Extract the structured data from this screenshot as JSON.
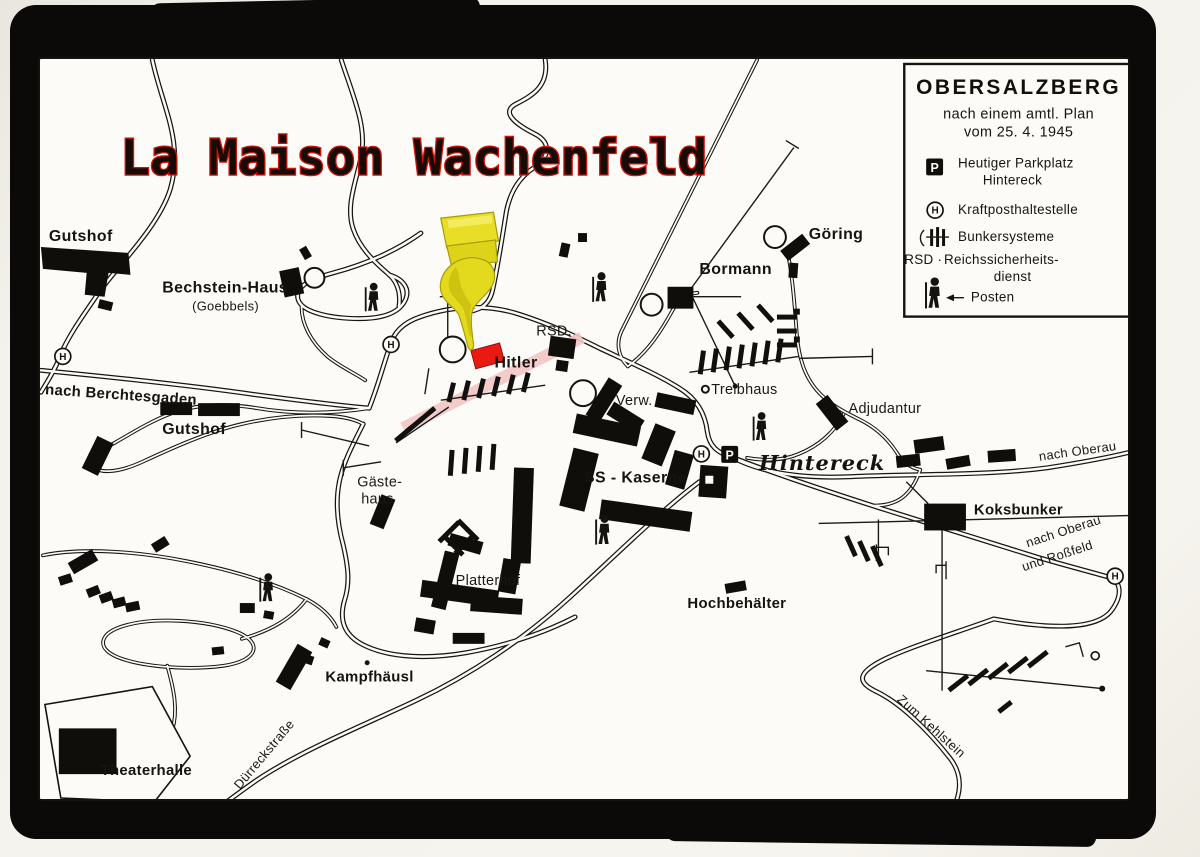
{
  "title": "La Maison Wachenfeld",
  "legend": {
    "heading": "OBERSALZBERG",
    "line1": "nach einem amtl. Plan",
    "line2": "vom 25. 4. 1945",
    "parkplatz_line1": "Heutiger Parkplatz",
    "parkplatz_line2": "Hintereck",
    "kraftpost": "Kraftposthaltestelle",
    "bunker": "Bunkersysteme",
    "rsd_prefix": "RSD ·",
    "rsd_line1": "Reichssicherheits-",
    "rsd_line2": "dienst",
    "posten": "Posten"
  },
  "symbols": {
    "p": "P",
    "h": "H"
  },
  "map_labels": {
    "gutshof_nw": "Gutshof",
    "bechstein_haus": "Bechstein-Haus",
    "goebbels": "(Goebbels)",
    "nach_berchtesgaden": "nach Berchtesgaden",
    "gutshof_s": "Gutshof",
    "gaestehaus_line1": "Gäste-",
    "gaestehaus_line2": "haus",
    "rsd": "RSD.",
    "hitler": "Hitler",
    "verw": "Verw.",
    "bormann": "Bormann",
    "goering": "Göring",
    "treibhaus": "Treibhaus",
    "adjudantur": "Adjudantur",
    "ss_kaserne": "SS - Kaserne",
    "hintereck": "Hintereck",
    "nach_oberau_top": "nach Oberau",
    "koksbunker": "Koksbunker",
    "nach_oberau_low_line1": "nach Oberau",
    "nach_oberau_low_line2": "und Roßfeld",
    "hochbehaelter": "Hochbehälter",
    "platterhof": "Platterhof",
    "kampfhaeusl": "Kampfhäusl",
    "theaterhalle": "Theaterhalle",
    "duerreckstrasse": "Dürreckstraße",
    "zum_kehlstein": "Zum Kehlstein"
  },
  "colors": {
    "title_red": "#cf1408",
    "marker_red": "#e81a12",
    "hand_yellow": "#e3da1e",
    "highlight_pink": "#f2c6c6",
    "frame_black": "#0b0a08",
    "paper_white": "#fcfbf7"
  }
}
